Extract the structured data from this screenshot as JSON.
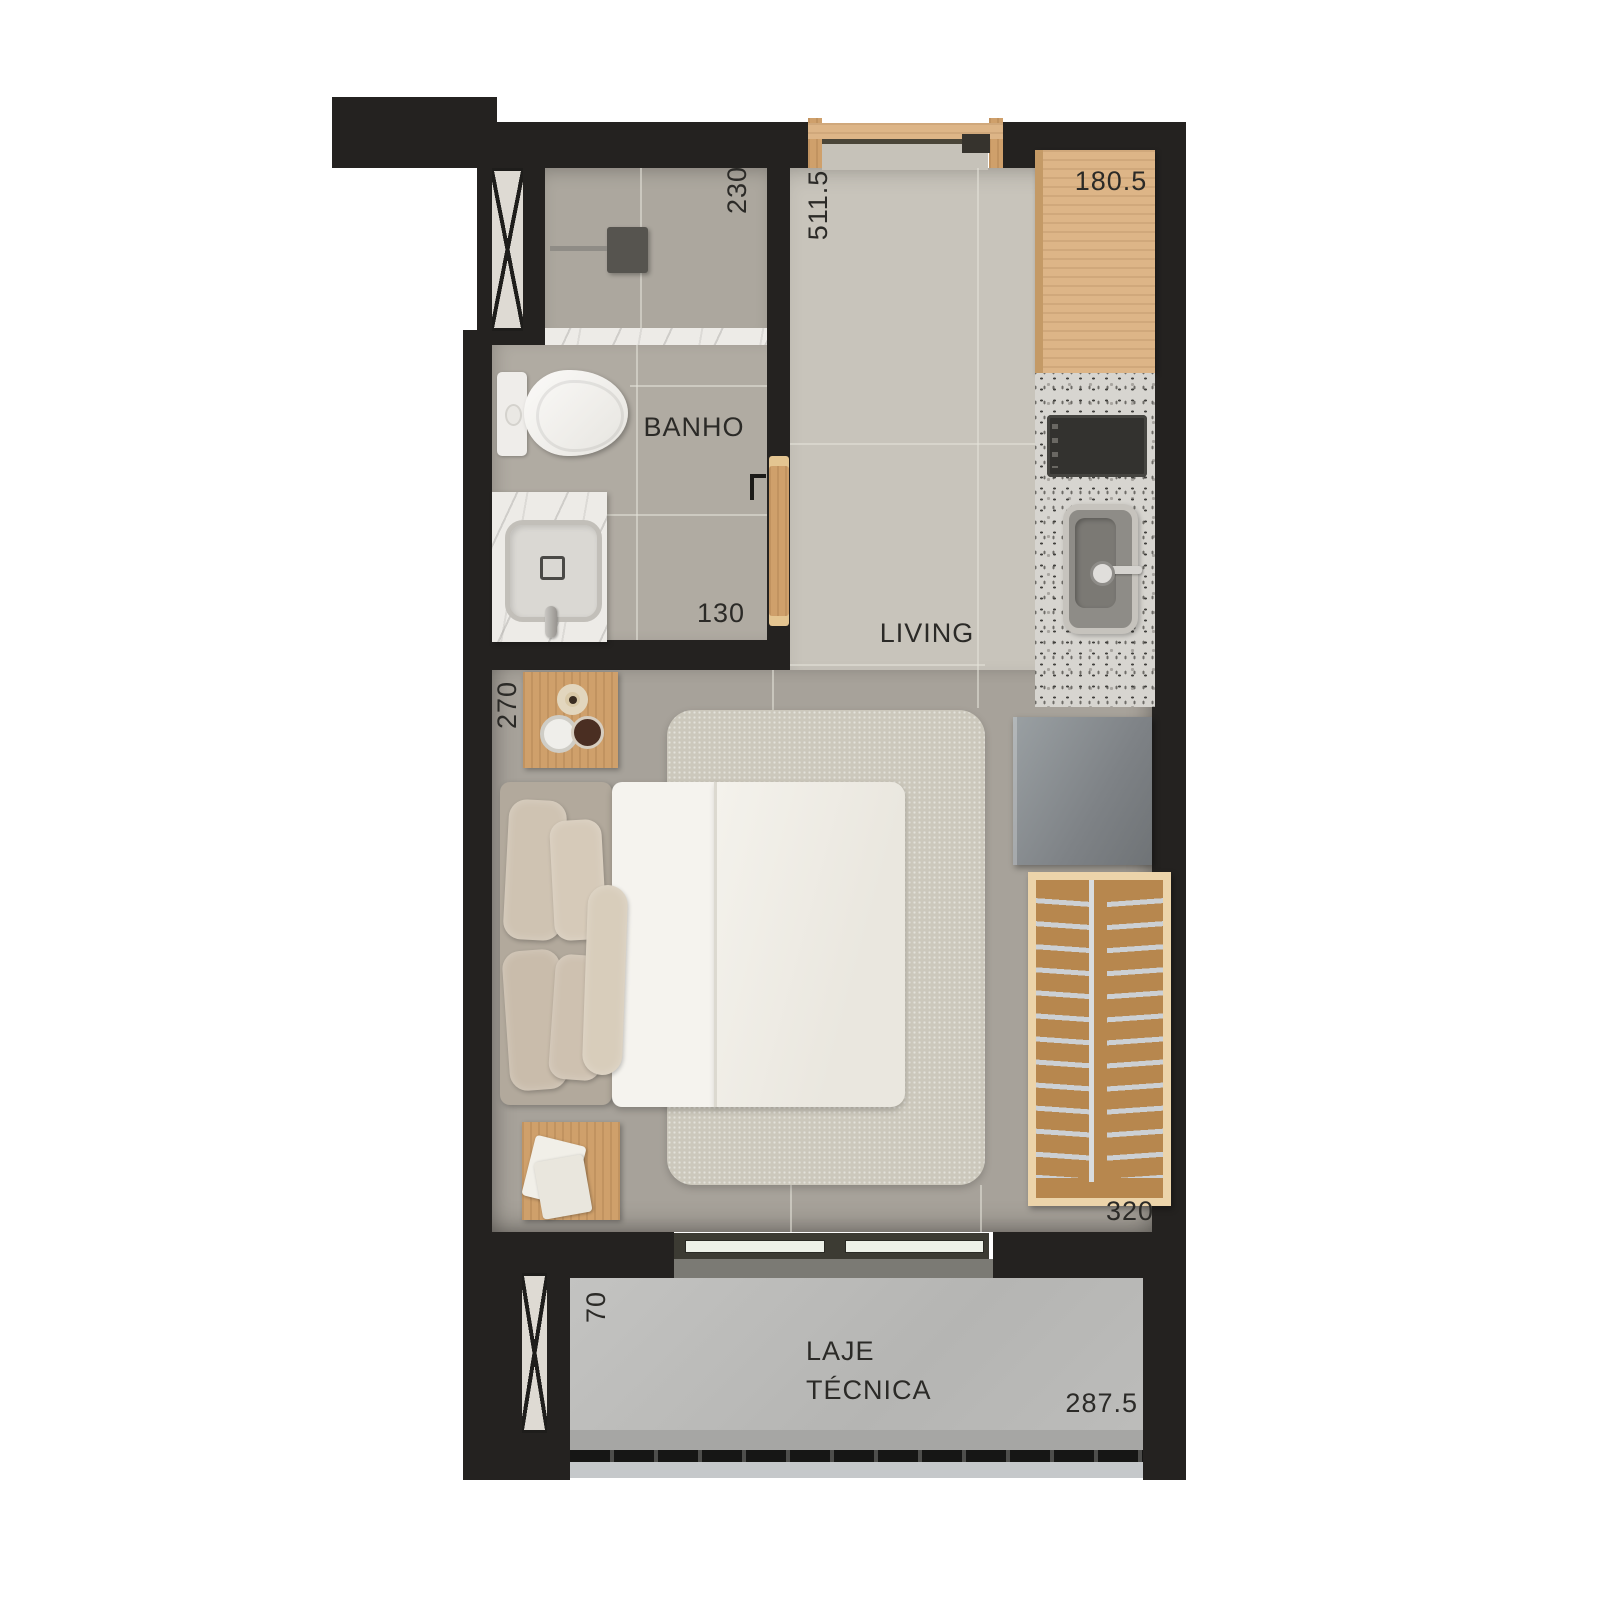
{
  "plan": {
    "type": "studio-apartment-floor-plan",
    "rooms": {
      "bathroom": "BANHO",
      "living": "LIVING",
      "technical_slab": "LAJE TÉCNICA"
    },
    "dimensions_cm": {
      "bath_shower_depth": "230",
      "living_length": "511.5",
      "kitchen_counter": "180.5",
      "bath_width": "130",
      "bed_wall": "270",
      "wardrobe_wall": "320",
      "slab_depth": "70",
      "slab_width": "287.5"
    },
    "palette": {
      "wall": "#242220",
      "floor_living": "#c8c4bb",
      "floor_bathroom": "#b0aba2",
      "floor_bedroom": "#a7a29a",
      "wood": "#cb9c69",
      "granite": "#d7d5d0",
      "marble": "#edebe7",
      "slab": "#bdbdbb",
      "fixture_white": "#f4f3f0",
      "text": "#2b2a27"
    },
    "furniture": [
      "double-bed",
      "rug",
      "pillows",
      "side-tables",
      "coffee-decor",
      "books",
      "toilet",
      "vanity-sink",
      "shower-head",
      "bathroom-door",
      "kitchen-upper-cabinet",
      "cooktop",
      "kitchen-sink",
      "fridge",
      "wardrobe-hangers",
      "balcony-sliding-door",
      "slab-sliding-window",
      "vent-shafts",
      "louver-grille"
    ]
  }
}
